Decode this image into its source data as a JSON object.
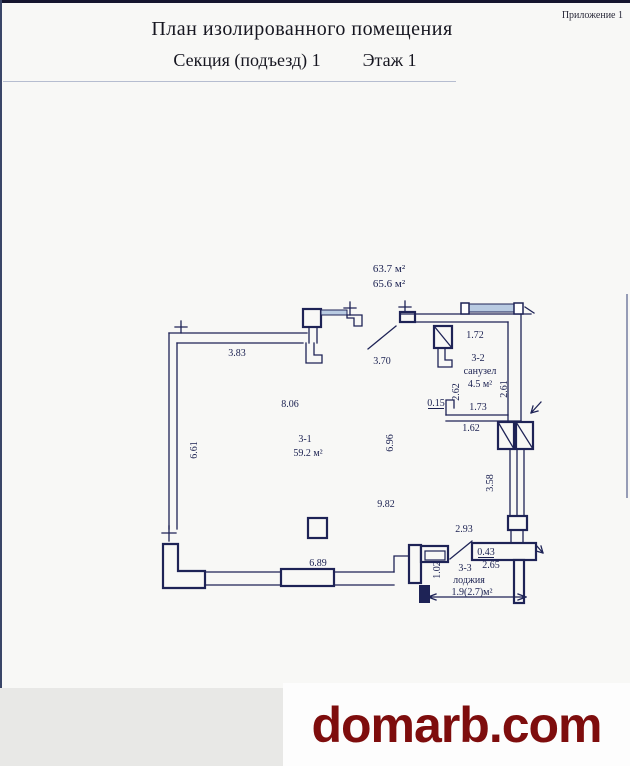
{
  "page": {
    "appendix": "Приложение 1",
    "title": "План изолированного помещения",
    "section_label": "Секция (подъезд) 1",
    "floor_label": "Этаж 1"
  },
  "plan": {
    "colors": {
      "line": "#1e2356",
      "text": "#1a2050",
      "window_fill": "#b9cbe2",
      "paper": "#f8f8f6"
    },
    "labels": [
      {
        "name": "area-total-1",
        "text": "63.7 м²",
        "x": 389,
        "y": 272,
        "size": 11
      },
      {
        "name": "area-total-2",
        "text": "65.6 м²",
        "x": 389,
        "y": 287,
        "size": 11
      },
      {
        "name": "dim-top-left-wall",
        "text": "3.83",
        "x": 237,
        "y": 356
      },
      {
        "name": "dim-entry-opening",
        "text": "3.70",
        "x": 382,
        "y": 364
      },
      {
        "name": "dim-bath-top",
        "text": "1.72",
        "x": 475,
        "y": 338
      },
      {
        "name": "dim-room-top",
        "text": "8.06",
        "x": 290,
        "y": 407
      },
      {
        "name": "dim-left-wall",
        "text": "6.61",
        "x": 197,
        "y": 450,
        "rot": -90
      },
      {
        "name": "room1-number",
        "text": "3-1",
        "x": 305,
        "y": 442
      },
      {
        "name": "room1-area",
        "text": "59.2 м²",
        "x": 308,
        "y": 456
      },
      {
        "name": "dim-room-mid-v",
        "text": "6.96",
        "x": 393,
        "y": 443,
        "rot": -90
      },
      {
        "name": "dim-room-mid-h",
        "text": "9.82",
        "x": 386,
        "y": 507
      },
      {
        "name": "room2-number",
        "text": "3-2",
        "x": 478,
        "y": 361
      },
      {
        "name": "room2-name",
        "text": "санузел",
        "x": 480,
        "y": 374
      },
      {
        "name": "room2-area",
        "text": "4.5 м²",
        "x": 480,
        "y": 387
      },
      {
        "name": "dim-bath-left",
        "text": "2.62",
        "x": 459,
        "y": 392,
        "rot": -90
      },
      {
        "name": "dim-bath-right",
        "text": "2.61",
        "x": 507,
        "y": 389,
        "rot": -90
      },
      {
        "name": "dim-bath-notch",
        "text": "0.15",
        "x": 436,
        "y": 406,
        "underline": true
      },
      {
        "name": "dim-bath-bottom",
        "text": "1.73",
        "x": 478,
        "y": 410
      },
      {
        "name": "dim-below-bath",
        "text": "1.62",
        "x": 471,
        "y": 431
      },
      {
        "name": "dim-right-window",
        "text": "3.58",
        "x": 493,
        "y": 483,
        "rot": -90
      },
      {
        "name": "dim-loggia-diag",
        "text": "2.93",
        "x": 464,
        "y": 532
      },
      {
        "name": "dim-loggia-wall",
        "text": "0.43",
        "x": 486,
        "y": 555,
        "underline": true
      },
      {
        "name": "dim-loggia-width",
        "text": "2.65",
        "x": 491,
        "y": 568
      },
      {
        "name": "room3-number",
        "text": "3-3",
        "x": 465,
        "y": 571
      },
      {
        "name": "room3-name",
        "text": "лоджия",
        "x": 469,
        "y": 583
      },
      {
        "name": "room3-area",
        "text": "1.9(2.7)м²",
        "x": 472,
        "y": 595
      },
      {
        "name": "dim-loggia-depth",
        "text": "1.02",
        "x": 440,
        "y": 570,
        "rot": -90
      },
      {
        "name": "dim-bottom-wall",
        "text": "6.89",
        "x": 318,
        "y": 566
      }
    ]
  },
  "watermark": {
    "text": "domarb.com",
    "color": "#7e0d0d"
  }
}
